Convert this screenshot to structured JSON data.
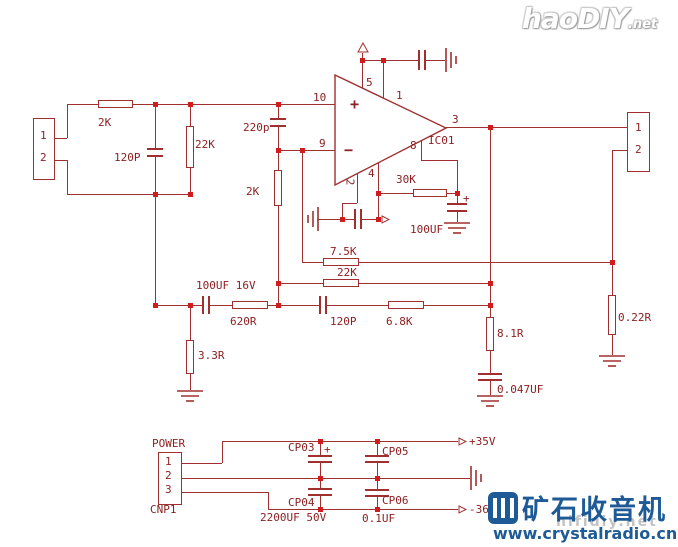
{
  "s": {
    "in1": "1",
    "in2": "2",
    "r2k_in": "2K",
    "c120p_in": "120P",
    "r22k_in": "22K",
    "c220p": "220p",
    "p10": "10",
    "p9": "9",
    "p5": "5",
    "p1": "1",
    "p3": "3",
    "p8": "8",
    "p4": "4",
    "p2": "2",
    "plus": "+",
    "minus": "−",
    "ic": "IC01",
    "r30k": "30K",
    "c100uf": "100UF",
    "c100uf_plus": "+",
    "r75k": "7.5K",
    "r22k_fb": "22K",
    "c120p_fb": "120P",
    "r68k": "6.8K",
    "r620": "620R",
    "c100uf16": "100UF 16V",
    "r33": "3.3R",
    "r81": "8.1R",
    "c047": "0.047UF",
    "r022": "0.22R",
    "out1": "1",
    "out2": "2",
    "power": "POWER",
    "cnp1": "CNP1",
    "pw1": "1",
    "pw2": "2",
    "pw3": "3",
    "cp03": "CP03",
    "cp03_plus": "+",
    "cp04": "CP04",
    "cp05": "CP05",
    "cp06": "CP06",
    "bigcap": "2200UF 50V",
    "smallcap": "0.1UF",
    "vpos": "+35V",
    "vneg": "-36V"
  },
  "wm": {
    "haodiy": "haoDIY",
    "net": ".net",
    "cn": "矿石收音机",
    "url": "www.crystalradio.cn",
    "hifidiy": "hifidiy.net"
  },
  "colors": {
    "wire": "#a03030",
    "junction": "#d01c1c",
    "label": "#8c2022",
    "brand_blue": "#1d5a96"
  }
}
